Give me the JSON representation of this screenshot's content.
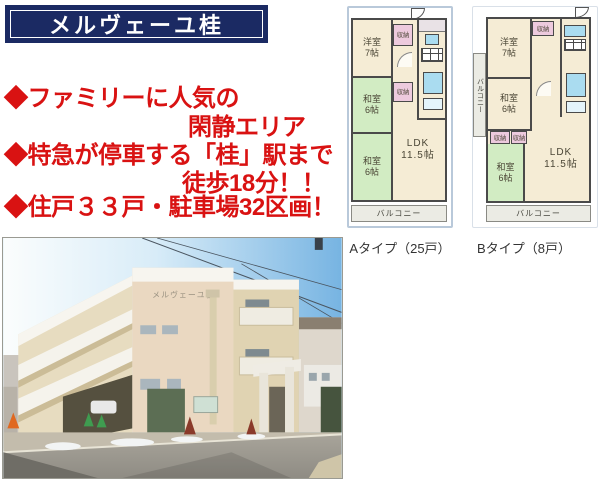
{
  "title": "メルヴェーユ桂",
  "bullets": [
    {
      "text": "◆ファミリーに人気の"
    },
    {
      "text": "閑静エリア"
    },
    {
      "text": "◆特急が停車する「桂」駅まで"
    },
    {
      "text": "徒歩18分！！"
    },
    {
      "text": "◆住戸３３戸・駐車場32区画！"
    }
  ],
  "photo": {
    "sign": "メルヴェーユ桂"
  },
  "plans": {
    "a": {
      "caption": "Aタイプ（25戸）",
      "rooms": {
        "western": "洋室\n7帖",
        "tatami1": "和室\n6帖",
        "tatami2": "和室\n6帖",
        "ldk": "LDK\n11.5帖",
        "closet1": "収納",
        "closet2": "収納",
        "balcony": "バルコニー"
      }
    },
    "b": {
      "caption": "Bタイプ（8戸）",
      "rooms": {
        "western": "洋室\n7帖",
        "tatami1": "和室\n6帖",
        "tatami2": "和室\n6帖",
        "ldk": "LDK\n11.5帖",
        "closet_top": "収納",
        "closet1": "収納",
        "closet2": "収納",
        "balcony": "バルコニー",
        "balcony_side": "バルコニー"
      }
    }
  },
  "colors": {
    "banner_navy": "#1b2a63",
    "bullet_red": "#d91212",
    "room_cream": "#f5ecd5",
    "room_green": "#d2ecc3",
    "closet_pink": "#edcade",
    "fixture_blue": "#aadcf0",
    "wall_gray": "#4a4a4a",
    "sky_blue": "#77b4e2"
  }
}
